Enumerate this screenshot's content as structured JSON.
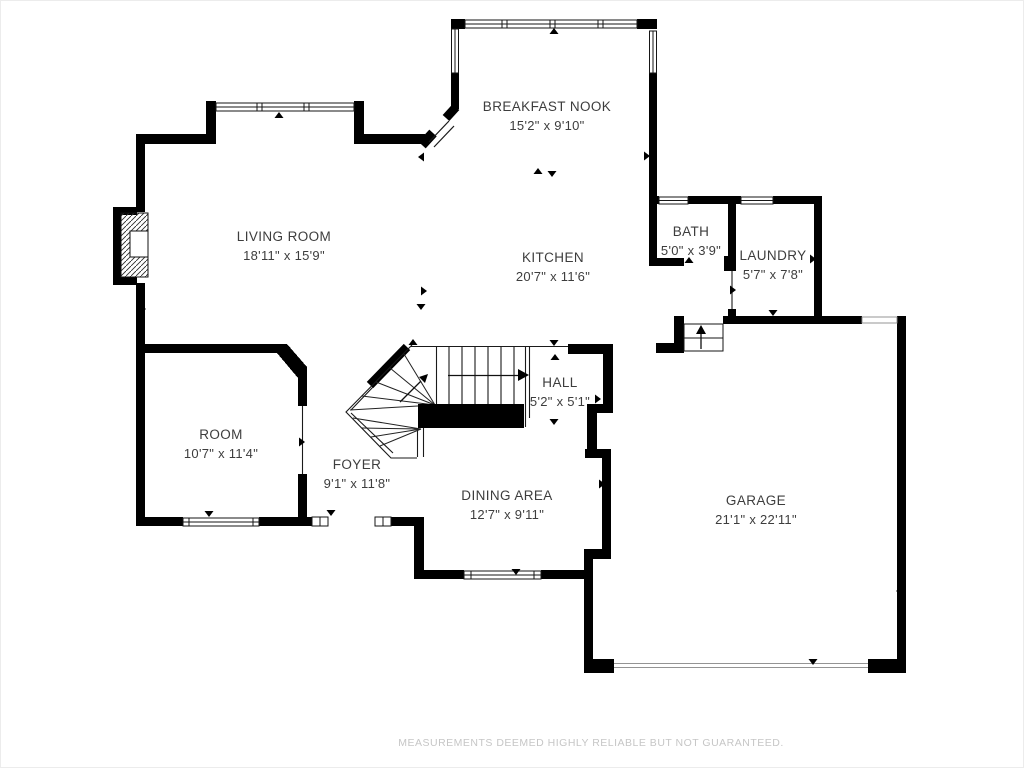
{
  "floorplan": {
    "rooms": [
      {
        "id": "breakfast-nook",
        "name": "BREAKFAST NOOK",
        "dims": "15'2\" x 9'10\""
      },
      {
        "id": "living-room",
        "name": "LIVING ROOM",
        "dims": "18'11\" x 15'9\""
      },
      {
        "id": "kitchen",
        "name": "KITCHEN",
        "dims": "20'7\" x 11'6\""
      },
      {
        "id": "bath",
        "name": "BATH",
        "dims": "5'0\" x 3'9\""
      },
      {
        "id": "laundry",
        "name": "LAUNDRY",
        "dims": "5'7\" x 7'8\""
      },
      {
        "id": "hall",
        "name": "HALL",
        "dims": "5'2\" x 5'1\""
      },
      {
        "id": "room",
        "name": "ROOM",
        "dims": "10'7\" x 11'4\""
      },
      {
        "id": "foyer",
        "name": "FOYER",
        "dims": "9'1\" x 11'8\""
      },
      {
        "id": "dining-area",
        "name": "DINING AREA",
        "dims": "12'7\" x 9'11\""
      },
      {
        "id": "garage",
        "name": "GARAGE",
        "dims": "21'1\" x 22'11\""
      }
    ],
    "disclaimer": "MEASUREMENTS DEEMED HIGHLY RELIABLE BUT NOT GUARANTEED.",
    "colors": {
      "wall": "#000000",
      "thin_line": "#1a1a1a",
      "label": "#3d3d3d",
      "disclaimer": "#c6c6c6",
      "background": "#ffffff"
    }
  }
}
